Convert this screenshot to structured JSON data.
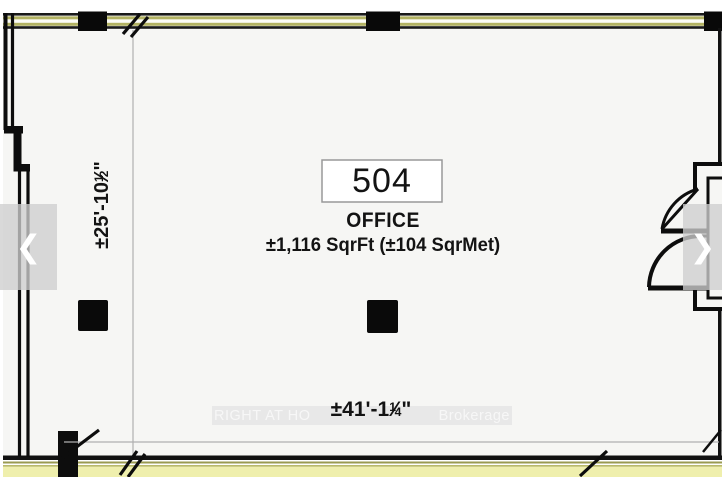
{
  "floorplan": {
    "unit_number": "504",
    "unit_type": "OFFICE",
    "area_text": "±1,116 SqrFt (±104 SqrMet)",
    "dimensions": {
      "vertical": {
        "prefix": "±25'-10",
        "numerator": "1",
        "slash": "⁄",
        "denominator": "2",
        "suffix": "\""
      },
      "horizontal": {
        "prefix": "±41'-1",
        "numerator": "1",
        "slash": "⁄",
        "denominator": "4",
        "suffix": "\""
      }
    },
    "watermark": {
      "left": "RIGHT AT HO",
      "right": "Brokerage"
    }
  },
  "carousel": {
    "icons": {
      "prev": "❮",
      "next": "❯"
    }
  },
  "colors": {
    "room_background": "#f6f6f4",
    "wall_black": "#111111",
    "window_stripe_olive": "#b3b363",
    "window_band_yellow": "#efefad",
    "dimension_line_gray": "#b0b0b0",
    "unit_box_border": "#999999",
    "watermark_text": "#f7f7f7",
    "watermark_strip": "#e7e7e7",
    "carousel_overlay": "#cecece",
    "chevron_white": "#ffffff"
  }
}
